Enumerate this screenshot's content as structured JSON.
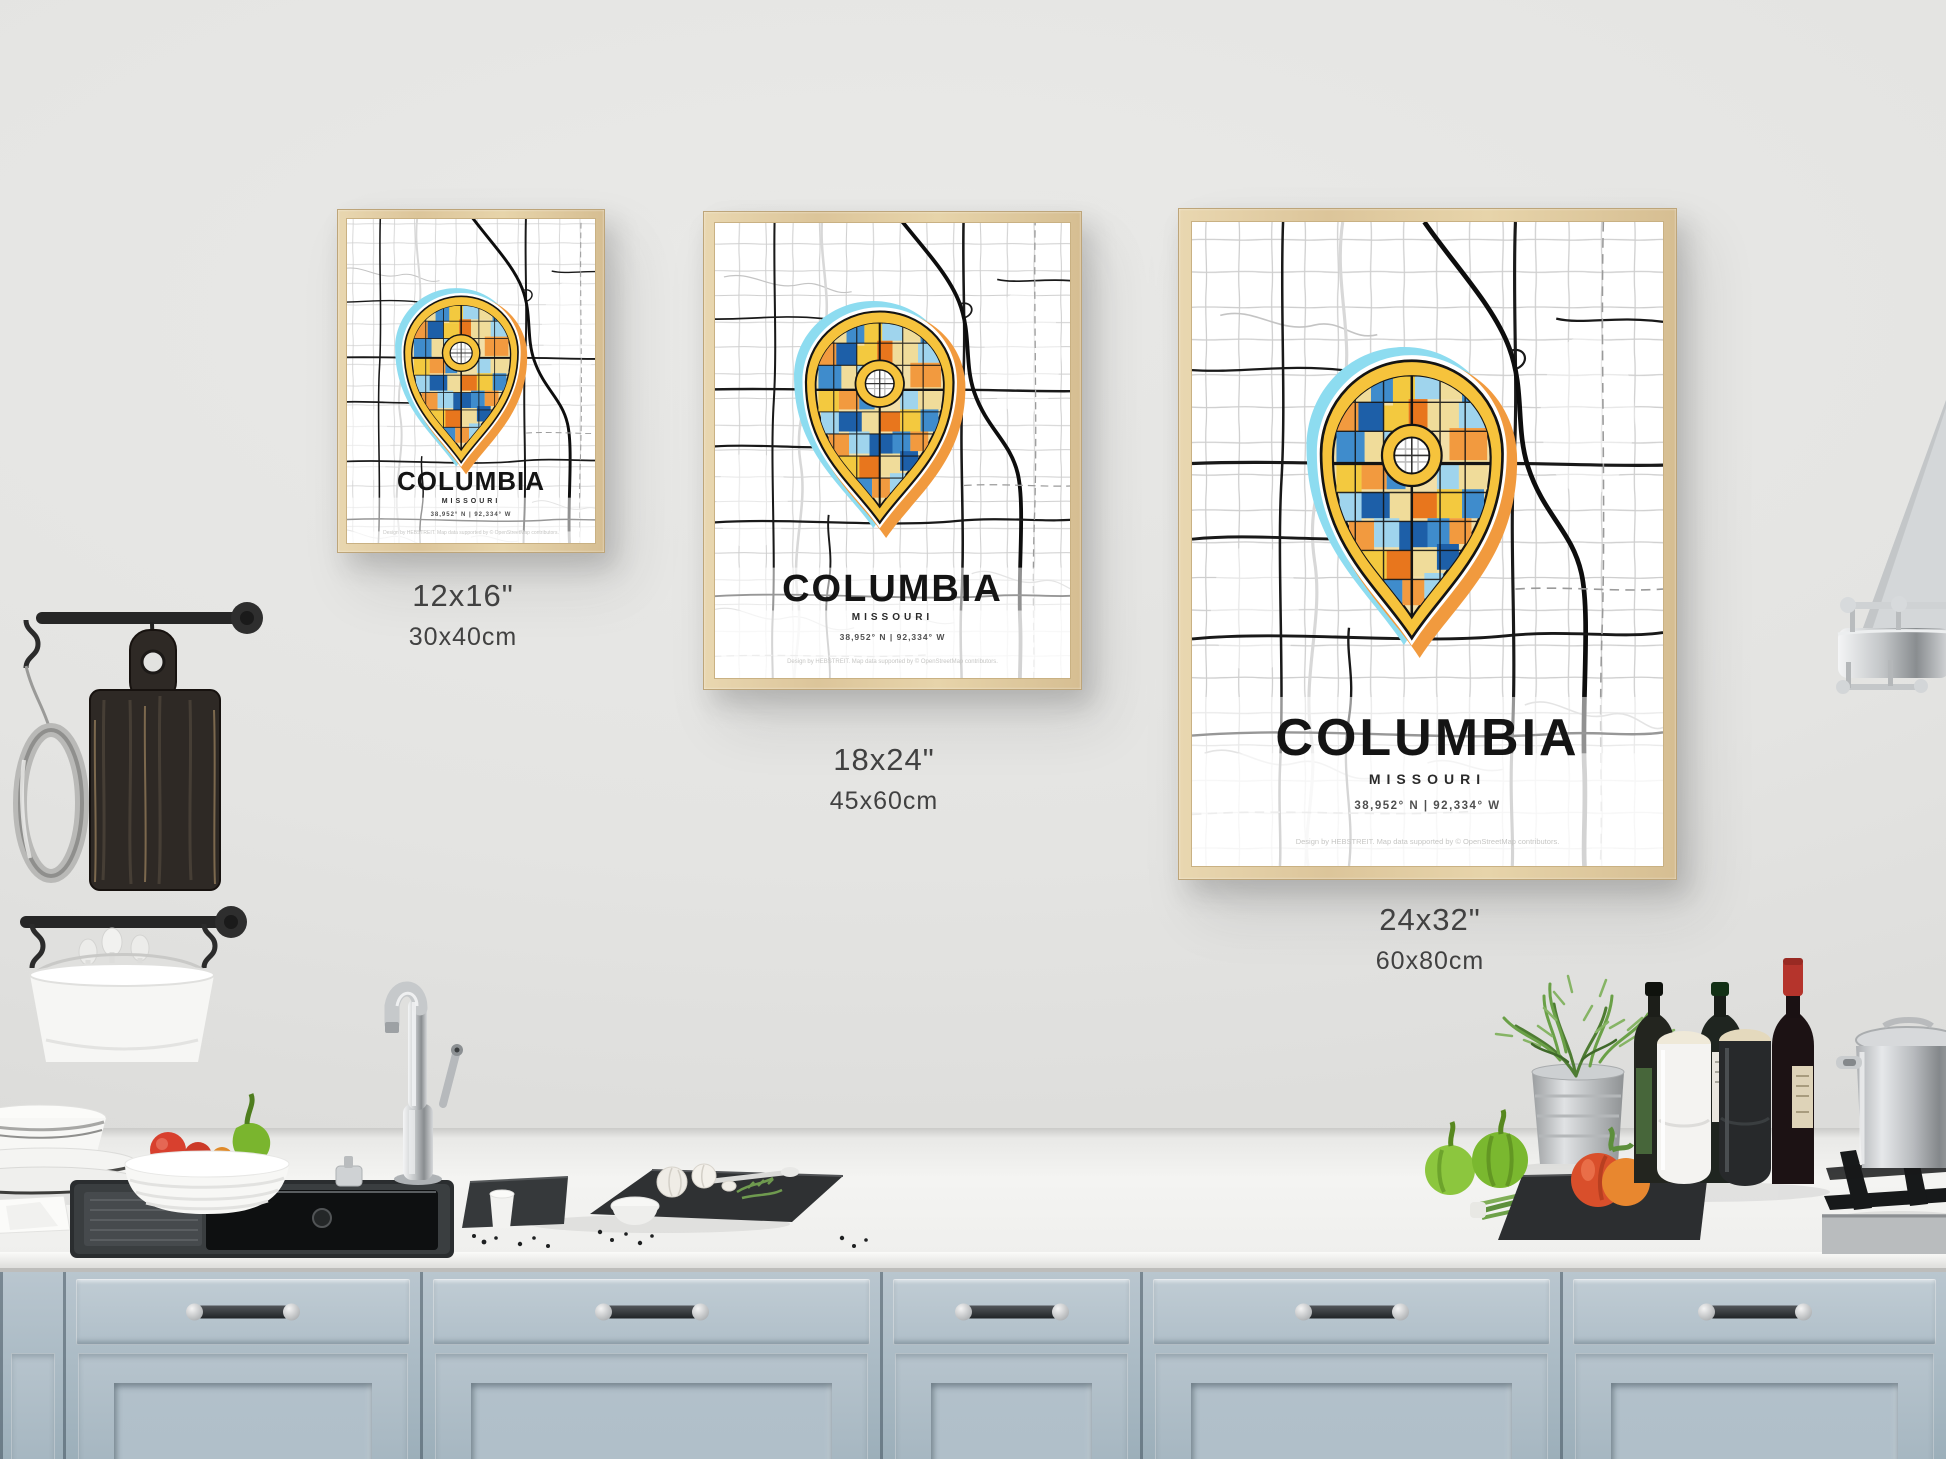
{
  "posters": [
    {
      "id": "poster-12x16",
      "title": "COLUMBIA",
      "state": "MISSOURI",
      "coordinates": "38,952° N | 92,334° W",
      "credit": "Design by HEBSTREIT. Map data supported by © OpenStreetMap contributors.",
      "size_inches": "12x16\"",
      "size_cm": "30x40cm"
    },
    {
      "id": "poster-18x24",
      "title": "COLUMBIA",
      "state": "MISSOURI",
      "coordinates": "38,952° N | 92,334° W",
      "credit": "Design by HEBSTREIT. Map data supported by © OpenStreetMap contributors.",
      "size_inches": "18x24\"",
      "size_cm": "45x60cm"
    },
    {
      "id": "poster-24x32",
      "title": "COLUMBIA",
      "state": "MISSOURI",
      "coordinates": "38,952° N | 92,334° W",
      "credit": "Design by HEBSTREIT. Map data supported by © OpenStreetMap contributors.",
      "size_inches": "24x32\"",
      "size_cm": "60x80cm"
    }
  ],
  "colors": {
    "wall": "#e4e4e2",
    "counter": "#f2f2f0",
    "cabinet": "#b3c1cb",
    "frame_wood": "#e0cba0",
    "pin_yellow": "#f6c33c",
    "pin_glow_blue": "#8ddcf0",
    "pin_glow_orange": "#f19a3e",
    "mosaic_deep_blue": "#1d5fa8",
    "mosaic_blue": "#3f8ccc",
    "mosaic_light_blue": "#9fd4ed",
    "mosaic_orange": "#e8761d",
    "mosaic_cream": "#f0dc9a",
    "map_road_dark": "#191919",
    "map_road_light": "#c9c9c9"
  }
}
